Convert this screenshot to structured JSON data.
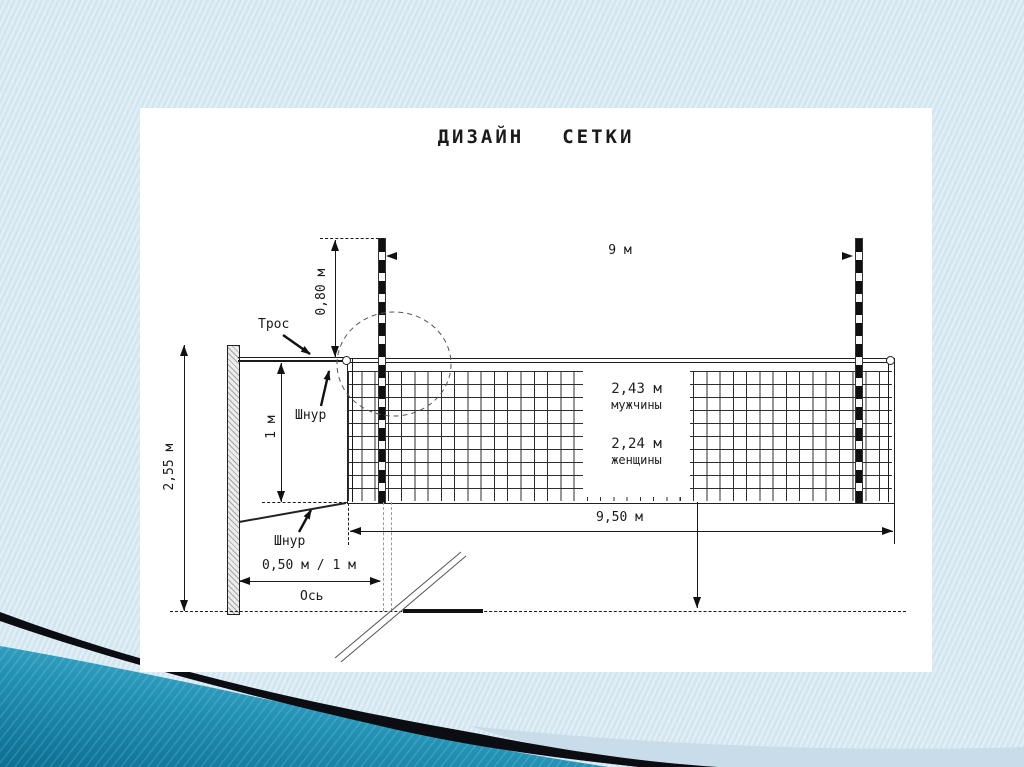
{
  "slide": {
    "title_word1": "ДИЗАЙН",
    "title_word2": "СЕТКИ"
  },
  "diagram": {
    "labels": {
      "top_width": "9 м",
      "antenna_overhang": "0,80 м",
      "cable": "Трос",
      "cord_top": "Шнур",
      "net_band_height": "1 м",
      "post_height": "2,55 м",
      "net_height_men": "2,43 м",
      "men_caption": "мужчины",
      "net_height_women": "2,24 м",
      "women_caption": "женщины",
      "net_length": "9,50 м",
      "post_distance": "0,50 м / 1 м",
      "axis": "Ось",
      "cord_bottom": "Шнур"
    }
  },
  "colors": {
    "background": "#d9eaf3",
    "content_background": "#ffffff",
    "accent_teal": "#1d86a9",
    "stripe_black": "#0b0d12",
    "line_color": "#1a1a1a"
  }
}
